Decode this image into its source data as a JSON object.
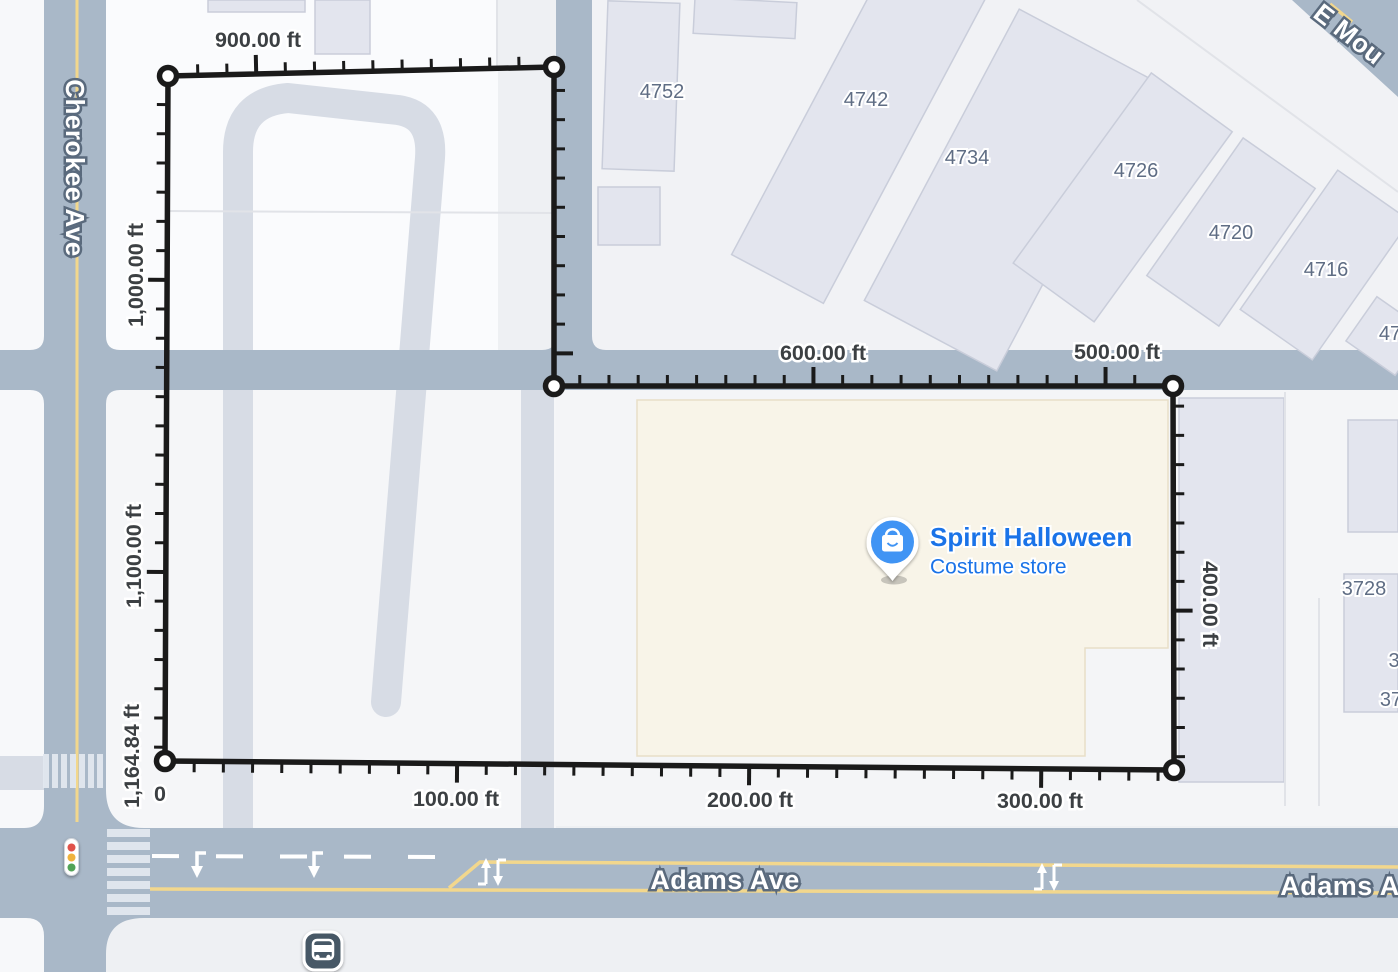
{
  "map": {
    "streets": {
      "cherokee": "Cherokee Ave",
      "adams": "Adams Ave",
      "adams_right_partial": "Adams A",
      "e_mountain_partial": "E Mou"
    },
    "building_labels": {
      "b4752": "4752",
      "b4742": "4742",
      "b4734": "4734",
      "b4726": "4726",
      "b4720": "4720",
      "b4716": "4716",
      "b47_partial": "47",
      "b3728": "3728",
      "b3_partial": "3",
      "b37_partial": "37"
    },
    "poi": {
      "name": "Spirit Halloween",
      "category": "Costume store"
    },
    "icons": {
      "poi_pin": "shopping-bag-pin-icon",
      "bus": "bus-stop-icon",
      "traffic_light": "traffic-light-icon"
    },
    "colors": {
      "road": "#a9b8c8",
      "parcel": "#eef0f3",
      "driveway": "#d7dce5",
      "building": "#e3e5ee",
      "store_building": "#f8f4e8",
      "yellow_line": "#f2d78d",
      "measure_line": "#1a1a1a",
      "poi_blue": "#4094f4",
      "poi_text": "#1a73e8"
    }
  },
  "measurement": {
    "unit": "ft",
    "total": "1,164.84 ft",
    "px_per_ft": 2.921,
    "tick_minor_ft": 10,
    "tick_major_ft": 100,
    "vertices": [
      [
        165,
        761
      ],
      [
        1174,
        770
      ],
      [
        1173,
        386
      ],
      [
        554,
        386
      ],
      [
        554,
        67
      ],
      [
        168,
        76
      ]
    ],
    "labels": [
      {
        "text": "0"
      },
      {
        "text": "100.00 ft"
      },
      {
        "text": "200.00 ft"
      },
      {
        "text": "300.00 ft"
      },
      {
        "text": "400.00 ft"
      },
      {
        "text": "500.00 ft"
      },
      {
        "text": "600.00 ft"
      },
      {
        "text": "900.00 ft"
      },
      {
        "text": "1,000.00 ft"
      },
      {
        "text": "1,100.00 ft"
      },
      {
        "text": "1,164.84 ft"
      }
    ]
  }
}
